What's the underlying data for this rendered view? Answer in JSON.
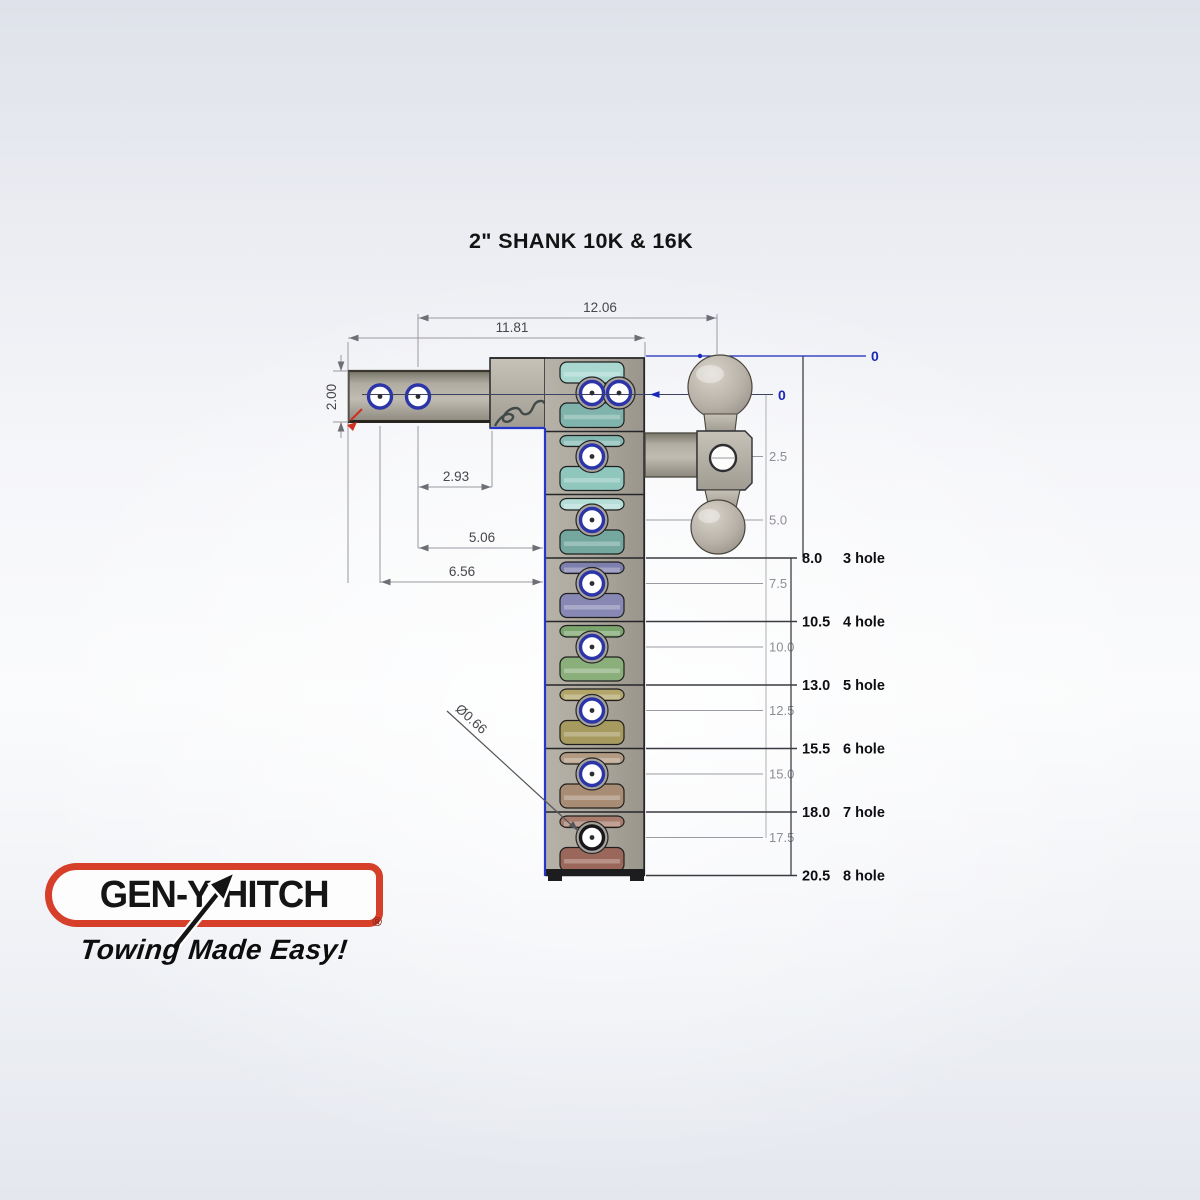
{
  "title": "2\" SHANK 10K & 16K",
  "drawing": {
    "dim_labels": {
      "top_outer": "12.06",
      "top_inner": "11.81",
      "shank_height": "2.00",
      "hole_to_face": "2.93",
      "hole_to_rack": "5.06",
      "front_hole_to_rack": "6.56",
      "pin_hole_diameter": "Ø0.66"
    },
    "zero_top": "0",
    "zero_hole": "0",
    "rise_ordinates": [
      "2.5",
      "5.0",
      "7.5",
      "10.0",
      "12.5",
      "15.0",
      "17.5"
    ],
    "drop_settings": [
      {
        "drop": "8.0",
        "holes": "3 hole"
      },
      {
        "drop": "10.5",
        "holes": "4 hole"
      },
      {
        "drop": "13.0",
        "holes": "5 hole"
      },
      {
        "drop": "15.5",
        "holes": "6 hole"
      },
      {
        "drop": "18.0",
        "holes": "7 hole"
      },
      {
        "drop": "20.5",
        "holes": "8 hole"
      }
    ],
    "colors": {
      "hole_ring_blue": "#2b35a8",
      "hole_ring_dark": "#17171d",
      "reference_blue": "#1b28b8",
      "rack_edge_blue": "#2636c8",
      "metal_gray": "#a8a49a",
      "red_accent": "#d03020",
      "tooth_palette": [
        "#a9d8d1",
        "#7fb3ab",
        "#84bab2",
        "#8fc6be",
        "#b4ded7",
        "#74a89f",
        "#7d7fad",
        "#8789b4",
        "#7ca56e",
        "#8aaf7b",
        "#b2a56a",
        "#a69a5e",
        "#b39a83",
        "#a88d74",
        "#a87d6e",
        "#9b675a"
      ]
    }
  },
  "logo": {
    "brand_prefix": "GEN-",
    "brand_y": "Y",
    "brand_suffix": "HITCH",
    "registered_mark": "®",
    "tagline": "Towing Made Easy!",
    "border_red": "#d6402b"
  }
}
